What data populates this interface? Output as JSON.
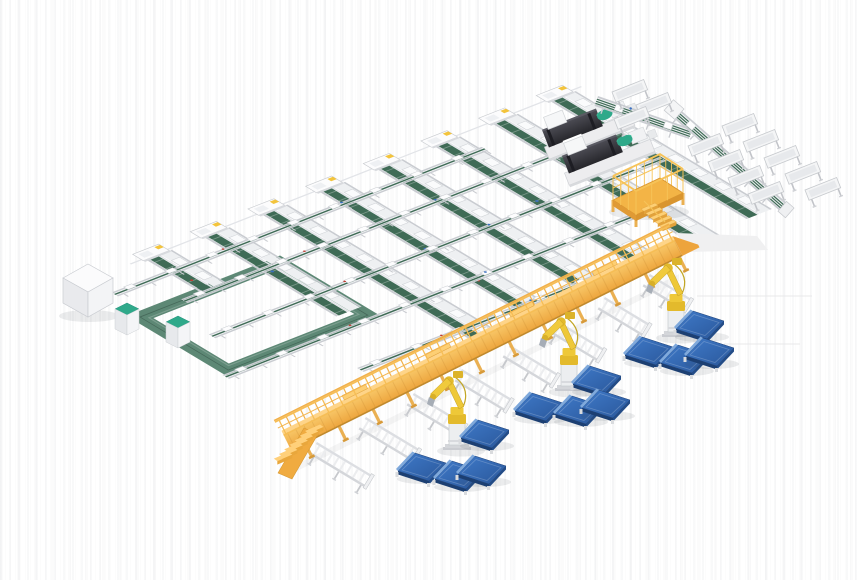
{
  "meta": {
    "description": "Isometric 3D render of an automated panel production line with conveyor lattice, CNC machines, maintenance platform, yellow gantry conveyor, robot arms and blue panels",
    "canvas_width": 860,
    "canvas_height": 580,
    "background": "#ffffff"
  },
  "colors": {
    "rail_gray": "#c9ccd1",
    "rail_light": "#e2e4e8",
    "lane_white": "#eef0f2",
    "belt_green": "#3f6b56",
    "belt_tick": "rgba(255,255,255,0.3)",
    "path_green": "#5d8875",
    "path_green_edge": "#46695a",
    "teal": "#2fa98a",
    "machine_dark_hi": "#4a4a52",
    "machine_dark_lo": "#26262b",
    "machine_darker": "#1d1d23",
    "gantry_top": "#fed488",
    "gantry_side_1": "#f8c768",
    "gantry_side_2": "#eda43c",
    "gantry_rib": "rgba(176,116,32,0.18)",
    "gantry_edge": "#c08a2e",
    "gantry_rail": "#f6bd55",
    "gantry_rail_far": "#f1b04a",
    "gantry_leg": "#eab052",
    "stair_tread": "#ffd07a",
    "stair_riser": "#e9a73c",
    "stair_side": "#f0ab40",
    "platform_yellow": "#f3b446",
    "platform_edge": "#d9952f",
    "platform_rail": "#f6c358",
    "robot_yellow": "#eec838",
    "robot_shade": "#c29f25",
    "pedestal": "#eceef0",
    "pedestal_edge": "#c7cacd",
    "panel_top_1": "#3f7ac9",
    "panel_top_2": "#2a579a",
    "panel_edge_light": "#7fa9dc",
    "panel_side_dark": "#1c3f72",
    "panel_side": "#234c87",
    "shadow": "rgba(60,65,75,0.10)",
    "mat": "#f0f0f1",
    "floor_line": "#e8e8ea",
    "dot_blue": "#3a6fc0",
    "dot_red": "#c23a2e",
    "marker_yellow": "#f3c43c",
    "white_face": "#f4f5f7"
  },
  "scene": {
    "lattice": {
      "origin": [
        150,
        262
      ],
      "band_spacing": 62,
      "band_lengths": [
        58,
        150,
        252,
        248,
        243,
        238,
        232,
        225
      ],
      "u_lines": [
        [
          18,
          -58,
          340
        ],
        [
          58,
          -20,
          420
        ],
        [
          112,
          -40,
          445
        ],
        [
          166,
          -75,
          380
        ],
        [
          220,
          20,
          320
        ]
      ]
    },
    "loop": {
      "origin": [
        140,
        317
      ],
      "width": 150,
      "height": 103,
      "band": 15
    },
    "white_box": [
      63,
      264
    ],
    "cabinets": [
      [
        115,
        303
      ],
      [
        166,
        316
      ]
    ],
    "machines": [
      [
        546,
        140
      ],
      [
        566,
        166
      ]
    ],
    "platform": [
      607,
      160
    ],
    "l_conveyor": {
      "u_seg": [
        598,
        96,
        19.3,
        100
      ],
      "v_seg": [
        676,
        106,
        41.2,
        150
      ]
    },
    "trays": [
      [
        612,
        92
      ],
      [
        636,
        105
      ],
      [
        614,
        119
      ],
      [
        722,
        126
      ],
      [
        743,
        142
      ],
      [
        764,
        158
      ],
      [
        785,
        174
      ],
      [
        805,
        190
      ],
      [
        688,
        146
      ],
      [
        708,
        162
      ],
      [
        728,
        178
      ],
      [
        748,
        194
      ]
    ],
    "gantry": {
      "start": [
        289,
        446
      ],
      "angle": -26.45,
      "length": 437
    },
    "stairs": {
      "steps": 7
    },
    "tables": [
      [
        317,
        442,
        66
      ],
      [
        366,
        417,
        64
      ],
      [
        414,
        393,
        62
      ],
      [
        462,
        369,
        60
      ],
      [
        510,
        345,
        58
      ],
      [
        558,
        321,
        56
      ],
      [
        605,
        297,
        54
      ],
      [
        650,
        274,
        50
      ]
    ],
    "robots": [
      [
        457,
        449
      ],
      [
        569,
        390
      ],
      [
        676,
        336
      ]
    ],
    "panels": [
      [
        693,
        311
      ],
      [
        642,
        337
      ],
      [
        678,
        345
      ],
      [
        703,
        338
      ],
      [
        590,
        366
      ],
      [
        532,
        393
      ],
      [
        572,
        396
      ],
      [
        599,
        390
      ],
      [
        478,
        420
      ],
      [
        415,
        453
      ],
      [
        452,
        461
      ],
      [
        475,
        456
      ]
    ],
    "floor_lines": [
      [
        697,
        296,
        115
      ],
      [
        724,
        344,
        76
      ]
    ],
    "mat": [
      [
        676,
        233
      ],
      [
        757,
        236
      ],
      [
        768,
        250
      ],
      [
        688,
        252
      ]
    ],
    "inventory": {
      "conveyor_bands": 8,
      "cross_conveyors": 5,
      "machine_covers": 8,
      "cnc_machines": 2,
      "tray_stands": 12,
      "outfeed_tables": 8,
      "robot_arms": 3,
      "blue_panels": 12,
      "cabinets": 2,
      "maintenance_platforms": 1,
      "gantry_conveyors": 1,
      "conveyor_loops": 1
    }
  }
}
